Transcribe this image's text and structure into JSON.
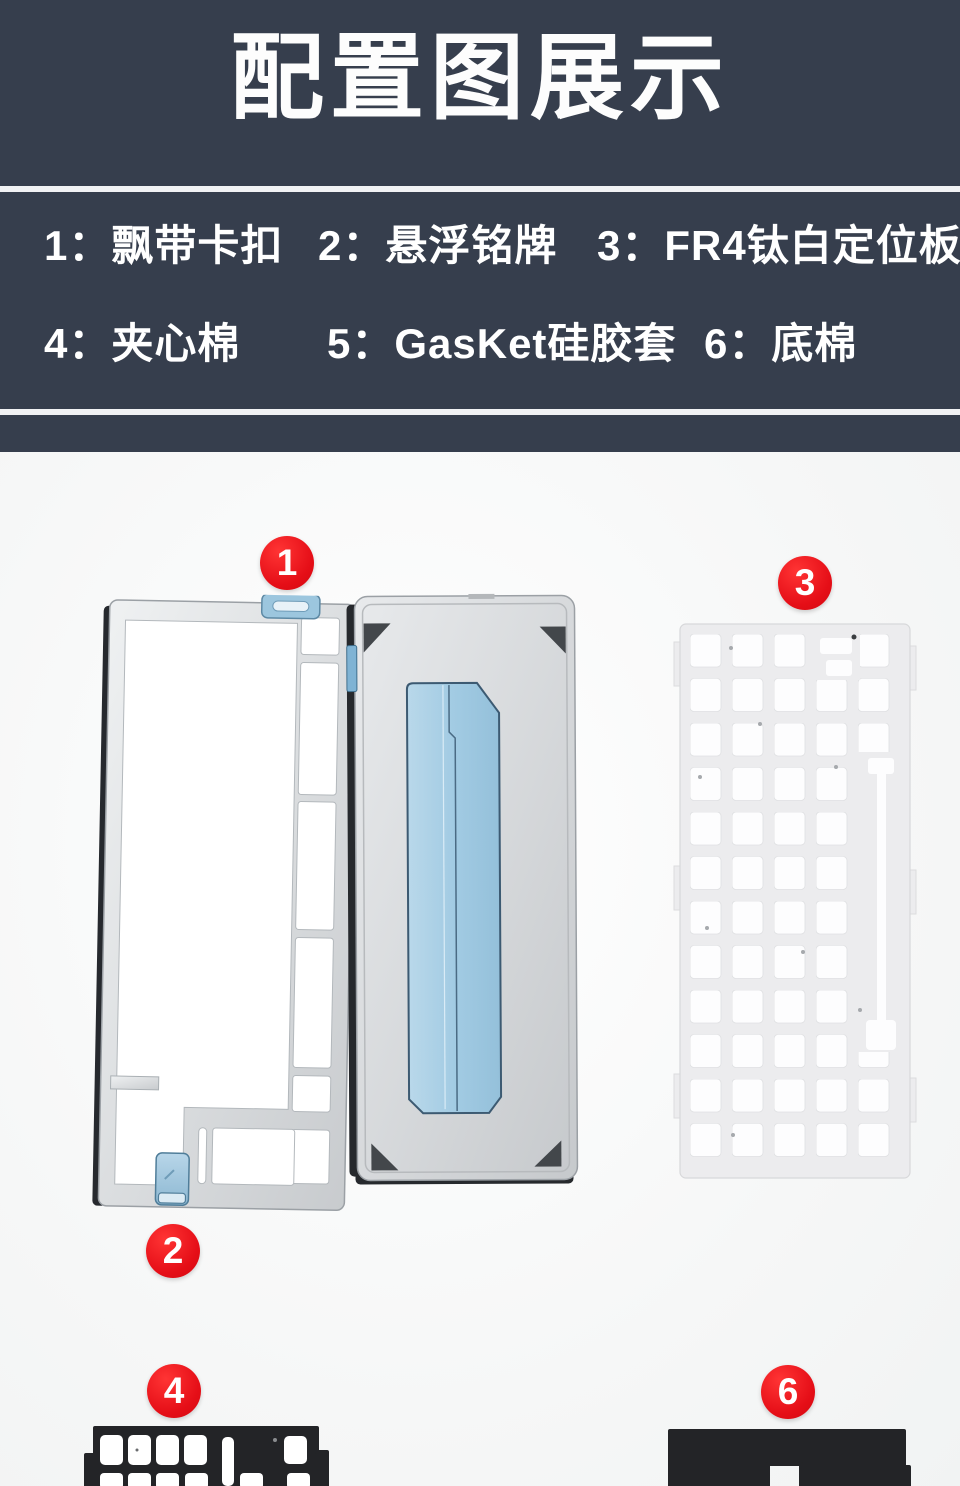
{
  "header": {
    "title": "配置图展示"
  },
  "legend": {
    "items": [
      {
        "label": "1：飘带卡扣"
      },
      {
        "label": "2：悬浮铭牌"
      },
      {
        "label": "3：FR4钛白定位板"
      },
      {
        "label": "4：夹心棉"
      },
      {
        "label": "5：GasKet硅胶套"
      },
      {
        "label": "6：底棉"
      }
    ]
  },
  "markers": [
    "1",
    "2",
    "3",
    "4",
    "6"
  ],
  "colors": {
    "band_navy": "#363e4d",
    "marker_red": "#e50e17",
    "clip_blue": "#a7cde4",
    "case_silver": "#d3d5d8",
    "plate_white": "#ececee",
    "foam_black": "#232427"
  }
}
